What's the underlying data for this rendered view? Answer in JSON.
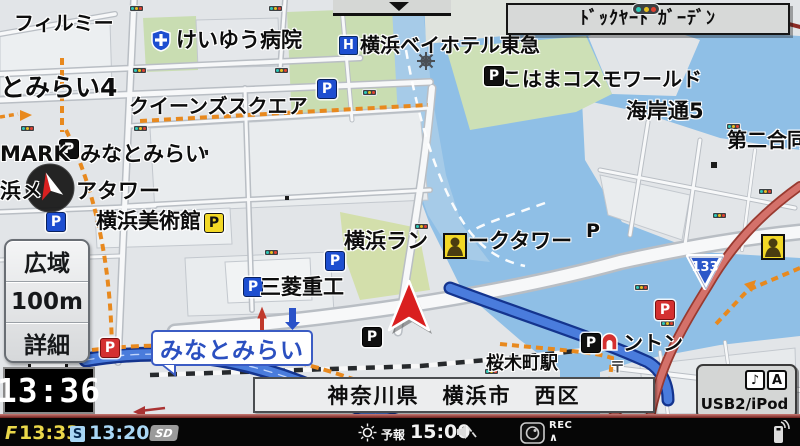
{
  "map": {
    "parking_label": "P",
    "hotel_icon_label": "H",
    "post_symbol": "〒",
    "route_badge": "133",
    "labels": {
      "film": "フィルミー",
      "hospital": "けいゆう病院",
      "hotel": "横浜ベイホテル東急",
      "cosmo": "こはまコスモワールド",
      "kaigan": "海岸通5",
      "daini": "第二合同",
      "mm4": "とみらい4",
      "queens": "クイーンズスクエア",
      "mark": "MARK",
      "markis_mm": "みなとみらい",
      "hama": "浜メ",
      "tower": "アタワー",
      "museum": "横浜美術館",
      "mitsubishi": "三菱重工",
      "landmark_l": "横浜ラン",
      "landmark_r": "ークタワー",
      "sakuragicho": "桜木町駅",
      "washington": "ントン"
    },
    "station_balloon": "みなとみらい"
  },
  "popup": {
    "intersection_name": "ﾄﾞｯｸﾔｰﾄﾞｶﾞｰﾃﾞﾝ"
  },
  "scale_panel": {
    "zoom_out": "広域",
    "scale": "100m",
    "zoom_in": "詳細"
  },
  "clock": {
    "time": "13:36"
  },
  "address_bar": {
    "text": "神奈川県　横浜市　西区"
  },
  "usb_panel": {
    "label": "USB2/iPod",
    "music_icon": "♪",
    "av_icon": "A"
  },
  "status_bar": {
    "goal_flag": "F",
    "goal_time": "13:33",
    "s_badge": "S",
    "s_time": "13:20",
    "sd_label": "SD",
    "forecast_label": "予報",
    "forecast_time": "15:00",
    "rec_label": "REC",
    "rec_caret": "∧"
  }
}
